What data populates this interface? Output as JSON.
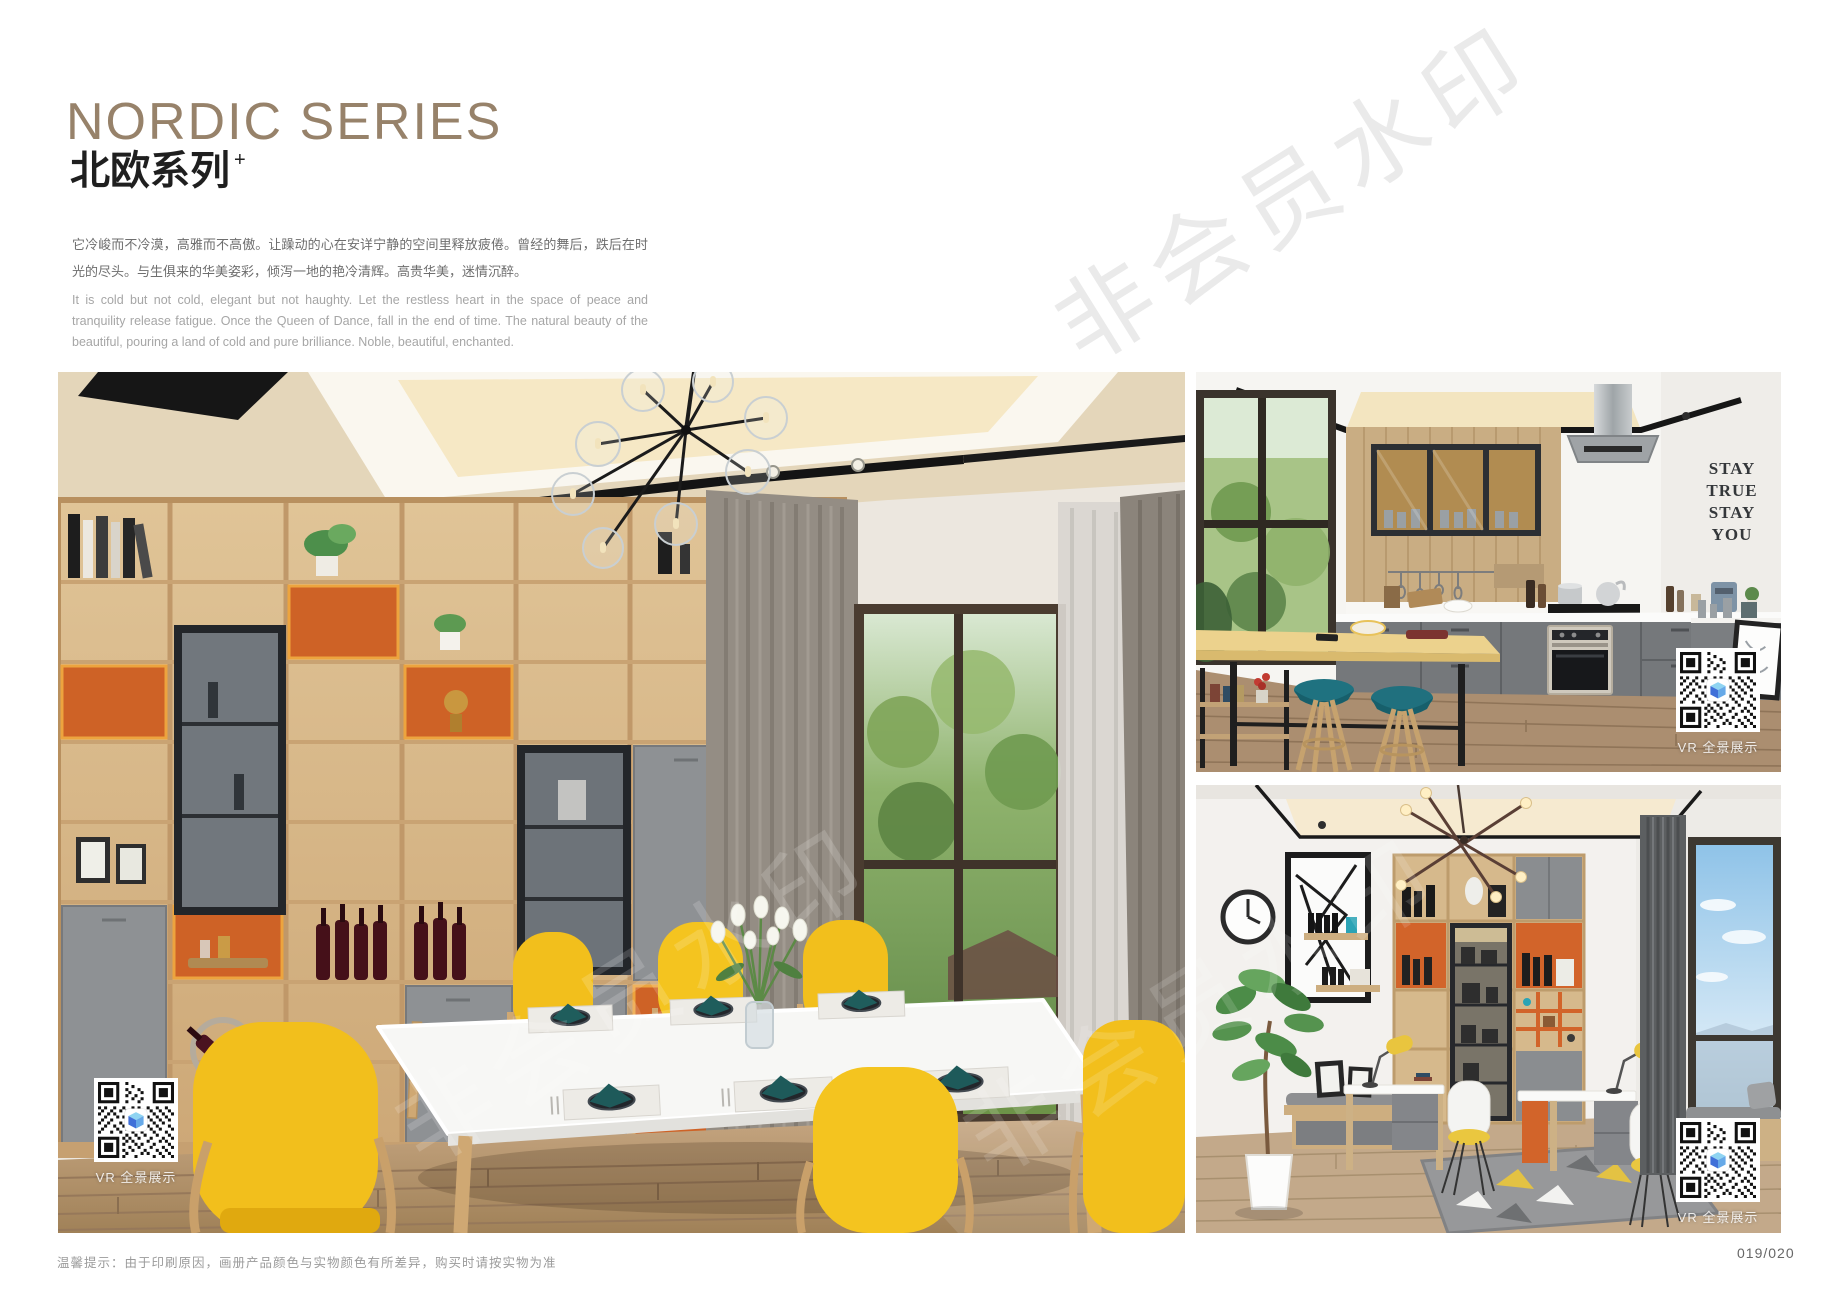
{
  "header": {
    "title": "NORDIC SERIES",
    "subtitle": "北欧系列",
    "subtitle_sup": "+",
    "desc_zh": "它冷峻而不冷漠，高雅而不高傲。让躁动的心在安详宁静的空间里释放疲倦。曾经的舞后，跌后在时光的尽头。与生俱来的华美姿彩，倾泻一地的艳冷清辉。高贵华美，迷情沉醉。",
    "desc_en": "It is cold but not cold, elegant but not haughty. Let the restless heart in the space of peace and tranquility release fatigue. Once the Queen of Dance, fall in the end of time. The natural beauty of the beautiful, pouring a land of cold and pure brilliance. Noble, beautiful, enchanted.",
    "title_color": "#97826a"
  },
  "photos": {
    "dining": {
      "name": "nordic dining room with yellow chairs"
    },
    "kitchen": {
      "name": "nordic open kitchen with bar stools",
      "wall_decor": [
        "STAY",
        "TRUE",
        "STAY",
        "YOU"
      ]
    },
    "study": {
      "name": "nordic study room with bookcase and desks"
    }
  },
  "qr": {
    "label": "VR 全景展示"
  },
  "watermark": {
    "text": "非会员水印"
  },
  "footer": {
    "note": "温馨提示：由于印刷原因，画册产品颜色与实物颜色有所差异，购买时请按实物为准",
    "page_number": "019/020"
  },
  "palette": {
    "title": "#97826a",
    "cabinet_orange": "#ce6226",
    "chair_yellow": "#f3c41e",
    "stool_teal": "#1f7280",
    "napkin_teal": "#1e5a5a",
    "wood": "#d8ba8c"
  }
}
